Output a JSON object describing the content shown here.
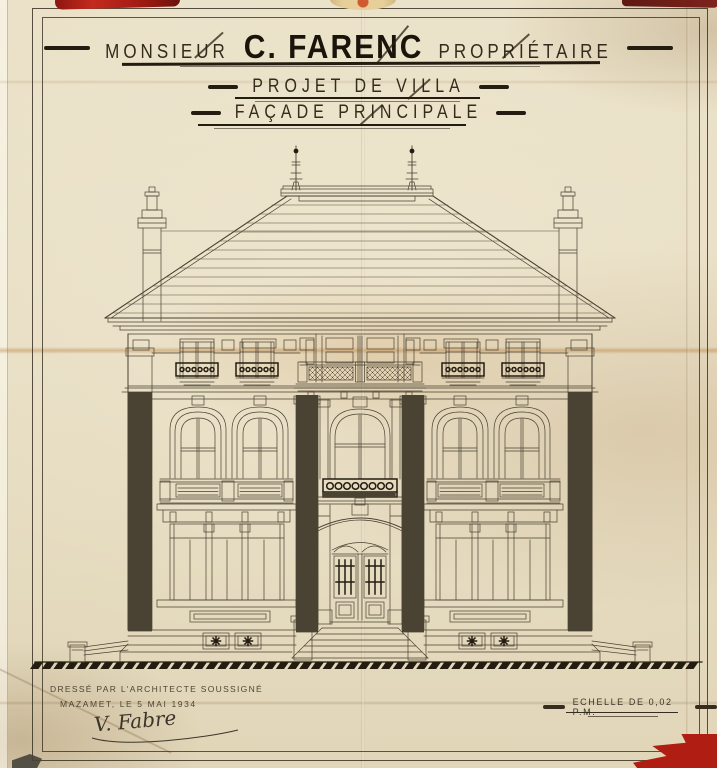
{
  "title_block": {
    "owner_prefix": "MONSIEUR",
    "owner_name": "C. FARENC",
    "owner_suffix": "PROPRIÉTAIRE",
    "project_line": "PROJET DE VILLA",
    "facade_line": "FAÇADE PRINCIPALE"
  },
  "signature_block": {
    "drafted_by": "DRESSÉ PAR L'ARCHITECTE SOUSSIGNÉ",
    "place_date": "MAZAMET, LE 5 MAI 1934",
    "signature": "V. Fabre"
  },
  "scale_block": {
    "scale_label": "ECHELLE DE 0,02 P.M."
  },
  "colors": {
    "paper": "#e8dfc6",
    "ink": "#4a4232",
    "ink_bold": "#241c10",
    "fold_stain": "#b87f3c",
    "pin_red": "#b01d12",
    "pushpin_gold": "#e7cf9a"
  }
}
